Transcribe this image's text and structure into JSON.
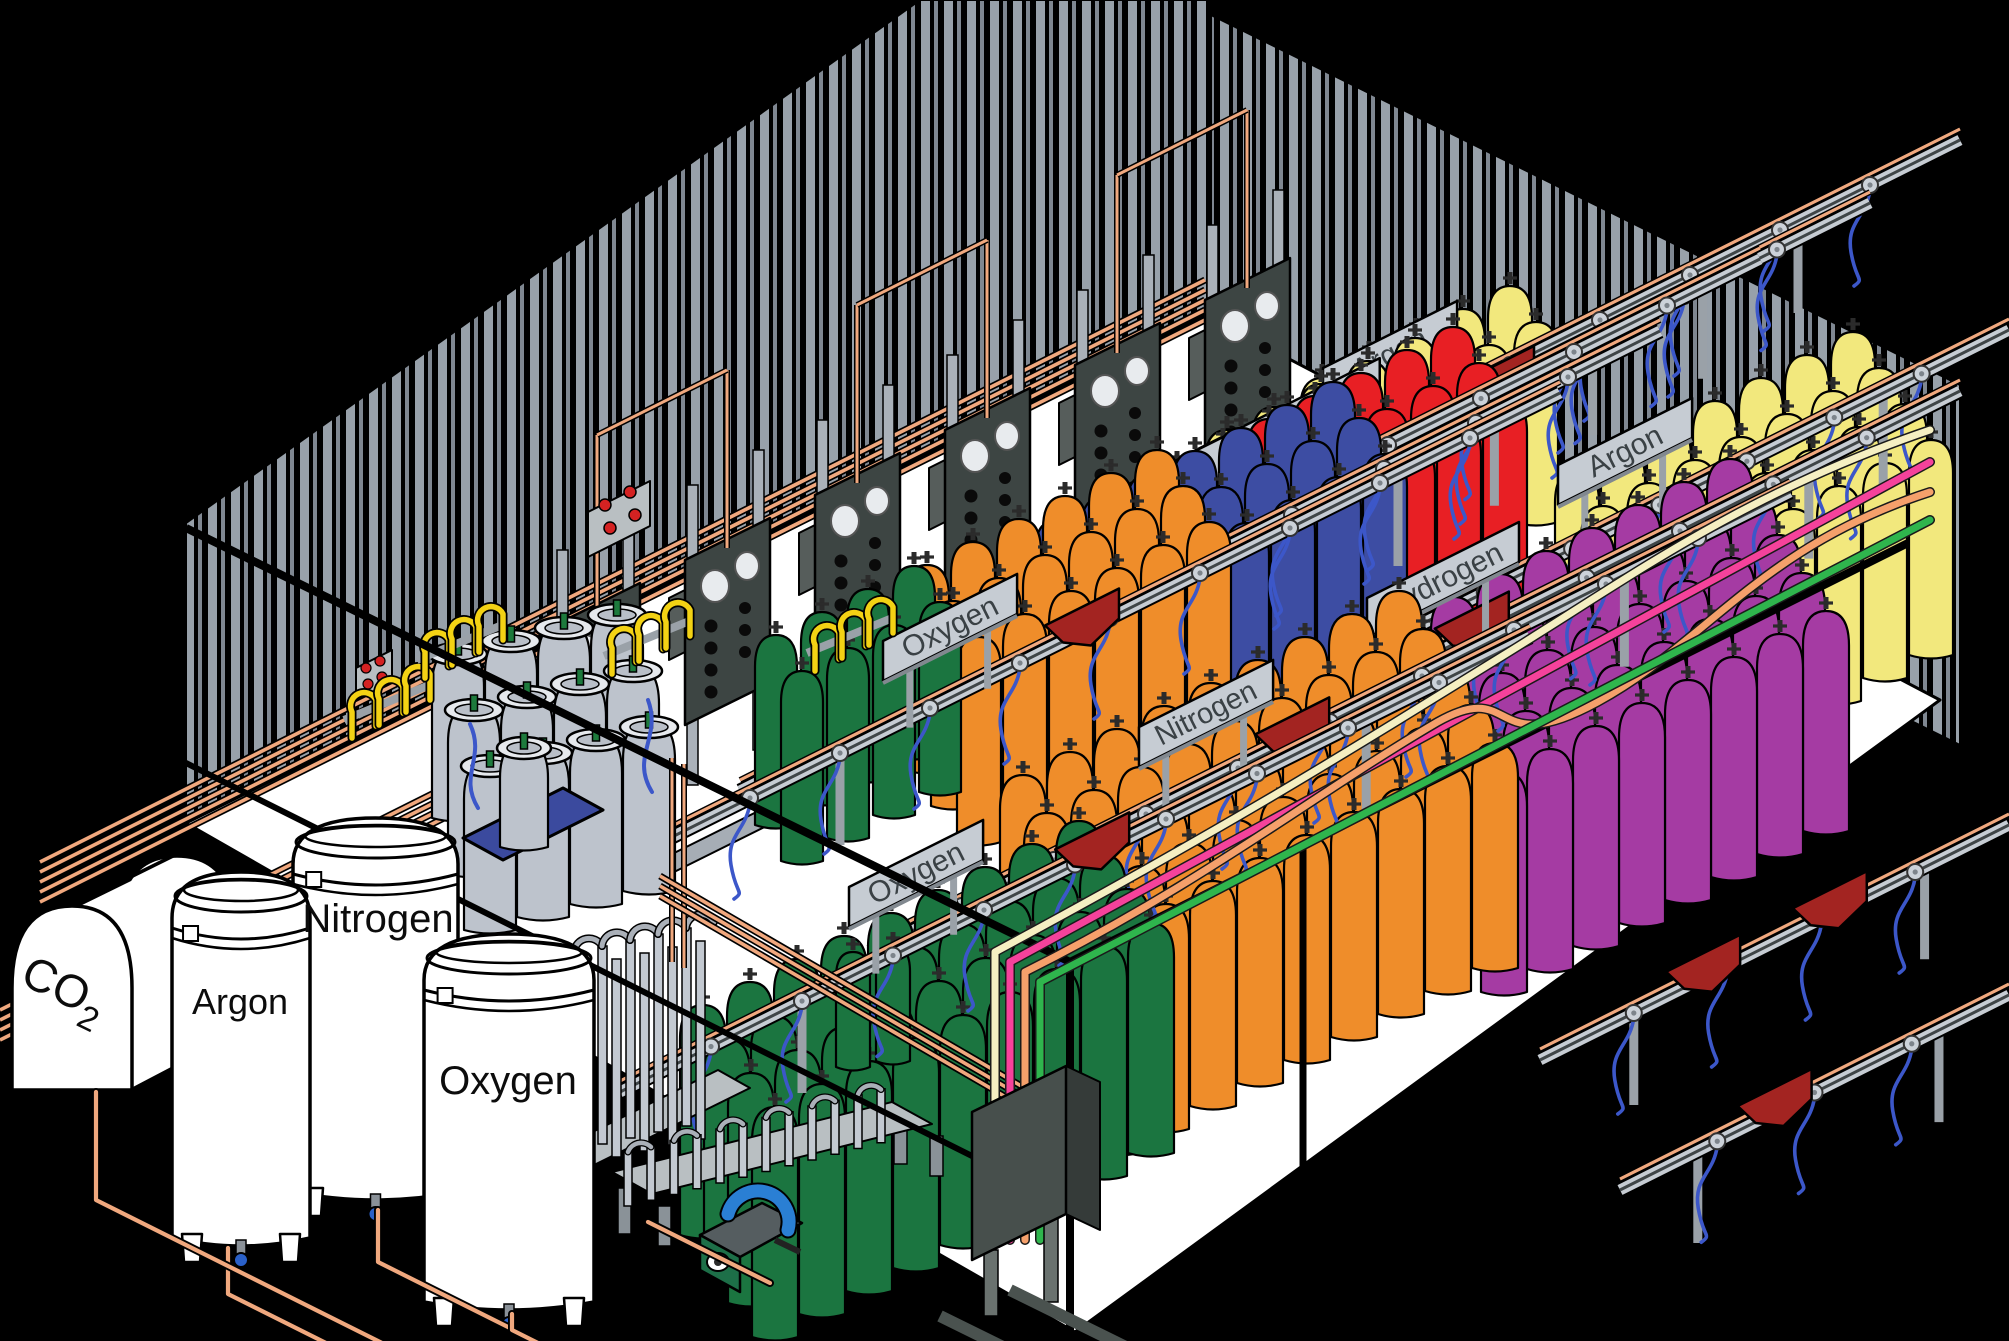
{
  "scene_title": "Industrial gas cylinder filling plant - isometric cutaway illustration",
  "colors": {
    "background": "#000000",
    "floor": "#ffffff",
    "wall_stripe": "#98a1aa",
    "wall_stripe_thin": "#7f8791",
    "copper_pipe": "#f0a87e",
    "rail_gray": "#c6ccd3",
    "rail_dark": "#3f4547",
    "panel_gray": "#3d4543",
    "sign_plate": "#c6ccd3",
    "sign_text": "#3a4145",
    "hose_blue": "#3c57c9",
    "hopper_red": "#a32421",
    "pallet_blue": "#3b4a9e",
    "pigtail_yellow": "#f3d214",
    "pump_teal": "#2a7fd4",
    "pump_green": "#1d6f48",
    "cylinder_green": "#1b7540",
    "cylinder_orange": "#ef8d2a",
    "cylinder_blue": "#3d4da3",
    "cylinder_red": "#e81f24",
    "cylinder_yellow": "#f2e87d",
    "cylinder_purple": "#a53ba3",
    "cylinder_gray": "#bdc3cc",
    "hose_cream": "#f5efc2",
    "hose_pink": "#f5429b",
    "hose_salmon": "#f5a06b",
    "hose_green": "#2fb54d"
  },
  "storage_tanks": [
    {
      "id": "co2",
      "label_main": "CO",
      "label_sub": "2"
    },
    {
      "id": "argon",
      "label": "Argon"
    },
    {
      "id": "nitrogen",
      "label": "Nitrogen"
    },
    {
      "id": "oxygen",
      "label": "Oxygen"
    }
  ],
  "rack_signs": [
    {
      "id": "oxygen-1",
      "label": "Oxygen"
    },
    {
      "id": "nitrogen-1",
      "label": "Nitrogen"
    },
    {
      "id": "helium",
      "label": "Helium"
    },
    {
      "id": "carbon-dioxide",
      "label": "Carbon Dioxide"
    },
    {
      "id": "argon-top",
      "label": "Argon"
    },
    {
      "id": "argon-right",
      "label": "Argon"
    },
    {
      "id": "hydrogen",
      "label": "Hydrogen"
    },
    {
      "id": "nitrogen-2",
      "label": "Nitrogen"
    },
    {
      "id": "oxygen-2",
      "label": "Oxygen"
    }
  ],
  "scene": {
    "walls": {
      "left": [
        [
          186,
          523
        ],
        [
          920,
          0
        ],
        [
          1211,
          0
        ],
        [
          1211,
          311
        ],
        [
          186,
          823
        ]
      ],
      "right": [
        [
          1211,
          15
        ],
        [
          1960,
          385
        ],
        [
          1960,
          745
        ],
        [
          1211,
          375
        ]
      ]
    },
    "floor": [
      [
        186,
        823
      ],
      [
        1211,
        318
      ],
      [
        1940,
        700
      ],
      [
        1075,
        1332
      ]
    ],
    "beams": [
      [
        640,
        870
      ],
      [
        900,
        745
      ],
      [
        1120,
        1010
      ],
      [
        1600,
        820
      ]
    ],
    "wall_bundles": [
      [
        40,
        862,
        1205,
        280,
        5
      ],
      [
        0,
        1010,
        640,
        690,
        4
      ]
    ],
    "panels": {
      "x0": 555,
      "y0": 625,
      "stepx": 130,
      "stepy": -65,
      "count": 6
    },
    "signs": [
      {
        "ax": 883,
        "ay": 641,
        "len": 150,
        "fs": 30
      },
      {
        "ax": 995,
        "ay": 573,
        "len": 150,
        "fs": 29
      },
      {
        "ax": 1091,
        "ay": 503,
        "len": 150,
        "fs": 30
      },
      {
        "ax": 1192,
        "ay": 452,
        "len": 210,
        "fs": 27
      },
      {
        "ax": 1323,
        "ay": 368,
        "len": 150,
        "fs": 30
      },
      {
        "ax": 1558,
        "ay": 465,
        "len": 150,
        "fs": 30
      },
      {
        "ax": 1367,
        "ay": 598,
        "len": 170,
        "fs": 30
      },
      {
        "ax": 1139,
        "ay": 727,
        "len": 150,
        "fs": 29
      },
      {
        "ax": 849,
        "ay": 887,
        "len": 150,
        "fs": 30
      }
    ],
    "rows": [
      {
        "sign": 4,
        "rail": [
          1060,
          590,
          1960,
          140
        ],
        "hoppers": [],
        "clusters": [
          {
            "o": [
              1300,
              378
            ],
            "c": 5,
            "r": 2,
            "cs": [
              47,
              -23
            ],
            "rs": [
              26,
              36
            ],
            "w": 44,
            "h": 200,
            "col": "cylinder_yellow"
          }
        ]
      },
      {
        "sign": 3,
        "rail": [
          940,
          668,
          1870,
          203
        ],
        "hoppers": [
          0.6
        ],
        "clusters": [
          {
            "o": [
              1205,
              430
            ],
            "c": 5,
            "r": 3,
            "cs": [
              47,
              -23
            ],
            "rs": [
              26,
              36
            ],
            "w": 44,
            "h": 205,
            "col": "cylinder_yellow"
          }
        ]
      },
      {
        "sign": 2,
        "rail": [
          830,
          724,
          1760,
          259
        ],
        "hoppers": [],
        "clusters": [
          {
            "o": [
              1155,
              465
            ],
            "c": 7,
            "r": 3,
            "cs": [
              46,
              -23
            ],
            "rs": [
              26,
              36
            ],
            "w": 44,
            "h": 200,
            "col": "cylinder_red"
          }
        ]
      },
      {
        "sign": 1,
        "rail": [
          740,
          791,
          1660,
          331
        ],
        "hoppers": [],
        "clusters": [
          {
            "o": [
              1035,
              520
            ],
            "c": 7,
            "r": 3,
            "cs": [
              46,
              -23
            ],
            "rs": [
              26,
              36
            ],
            "w": 44,
            "h": 205,
            "col": "cylinder_blue"
          }
        ]
      },
      {
        "sign": 0,
        "rail": [
          660,
          843,
          1560,
          393
        ],
        "hoppers": [
          0.47
        ],
        "clusters": [
          {
            "o": [
              905,
              565
            ],
            "c": 6,
            "r": 3,
            "cs": [
              46,
              -23
            ],
            "rs": [
              26,
              36
            ],
            "w": 44,
            "h": 205,
            "col": "cylinder_orange"
          },
          {
            "o": [
              755,
              635
            ],
            "c": 4,
            "r": 2,
            "cs": [
              46,
              -23
            ],
            "rs": [
              26,
              36
            ],
            "w": 42,
            "h": 190,
            "col": "cylinder_green"
          }
        ]
      },
      {
        "sign": 5,
        "rail": [
          1310,
          680,
          2009,
          330
        ],
        "hoppers": [
          0.1
        ],
        "clusters": [
          {
            "o": [
              1555,
              470
            ],
            "c": 7,
            "r": 4,
            "cs": [
              46,
              -23
            ],
            "rs": [
              26,
              36
            ],
            "w": 44,
            "h": 215,
            "col": "cylinder_yellow"
          }
        ]
      },
      {
        "sign": 6,
        "rail": [
          1120,
          811,
          1960,
          391
        ],
        "hoppers": [
          0.42
        ],
        "clusters": [
          {
            "o": [
              1385,
              620
            ],
            "c": 8,
            "r": 5,
            "cs": [
              46,
              -23
            ],
            "rs": [
              24,
              38
            ],
            "w": 46,
            "h": 220,
            "col": "cylinder_purple"
          }
        ]
      },
      {
        "sign": null,
        "rail": [
          1540,
          1060,
          2009,
          825
        ],
        "hoppers": [
          0.35,
          0.62
        ],
        "clusters": []
      },
      {
        "sign": 7,
        "rail": [
          870,
          952,
          1790,
          492
        ],
        "hoppers": [
          0.46
        ],
        "clusters": [
          {
            "o": [
              1000,
              775
            ],
            "c": 9,
            "r": 5,
            "cs": [
              47,
              -23
            ],
            "rs": [
              24,
              38
            ],
            "w": 46,
            "h": 225,
            "col": "cylinder_orange"
          }
        ]
      },
      {
        "sign": null,
        "rail": [
          1620,
          1190,
          2009,
          995
        ],
        "hoppers": [
          0.4
        ],
        "clusters": []
      },
      {
        "sign": 8,
        "rail": [
          620,
          1092,
          1530,
          637
        ],
        "hoppers": [
          0.52
        ],
        "clusters": [
          {
            "o": [
              680,
              1005
            ],
            "c": 9,
            "r": 4,
            "cs": [
              47,
              -23
            ],
            "rs": [
              24,
              34
            ],
            "w": 46,
            "h": 230,
            "col": "cylinder_green"
          },
          {
            "o": [
              836,
              952
            ],
            "c": 2,
            "r": 1,
            "cs": [
              40,
              -6
            ],
            "rs": [
              0,
              0
            ],
            "w": 34,
            "h": 115,
            "col": "cylinder_green"
          }
        ]
      }
    ],
    "dewars": {
      "o": [
        432,
        648
      ],
      "c": 4,
      "r": 3,
      "cs": [
        53,
        -13
      ],
      "rs": [
        16,
        56
      ],
      "w": 52,
      "h": 170,
      "col": "cylinder_gray",
      "type": "dewar"
    },
    "tanks": {
      "argon": {
        "x": 172,
        "w": 138,
        "top": 866,
        "bottom": 1238
      },
      "nitrogen": {
        "x": 293,
        "w": 165,
        "top": 812,
        "bottom": 1192
      },
      "oxygen": {
        "x": 424,
        "w": 170,
        "top": 928,
        "bottom": 1302
      }
    },
    "hoses": [
      {
        "x": 995,
        "ey": 952,
        "end": [
          1930,
          430
        ],
        "col": "hose_cream",
        "wave": 1
      },
      {
        "x": 1010,
        "ey": 962,
        "end": [
          1930,
          462
        ],
        "col": "hose_pink",
        "wave": 0
      },
      {
        "x": 1025,
        "ey": 972,
        "end": [
          1930,
          492
        ],
        "col": "hose_salmon",
        "wave": 2
      },
      {
        "x": 1040,
        "ey": 982,
        "end": [
          1930,
          520
        ],
        "col": "hose_green",
        "wave": 0
      }
    ]
  }
}
